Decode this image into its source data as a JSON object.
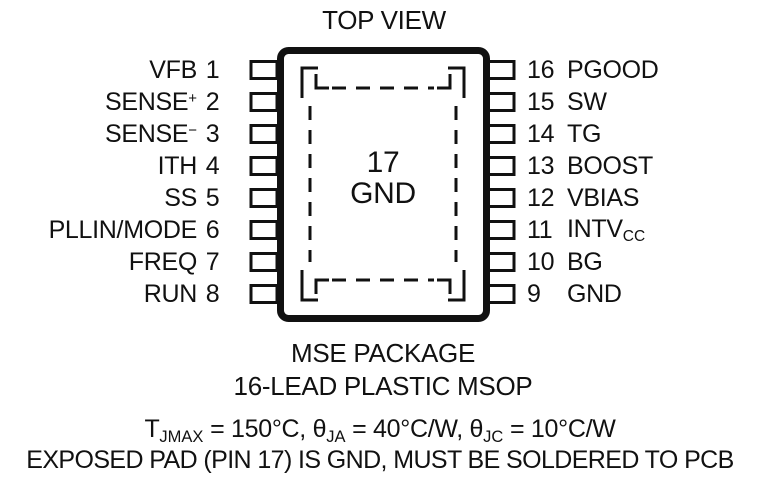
{
  "title": "TOP VIEW",
  "package": {
    "center_pad": {
      "num": "17",
      "label": "GND"
    },
    "pins_left": [
      {
        "num": "1",
        "name": "VFB"
      },
      {
        "num": "2",
        "name": "SENSE",
        "sup": "+"
      },
      {
        "num": "3",
        "name": "SENSE",
        "sup": "−"
      },
      {
        "num": "4",
        "name": "ITH"
      },
      {
        "num": "5",
        "name": "SS"
      },
      {
        "num": "6",
        "name": "PLLIN/MODE"
      },
      {
        "num": "7",
        "name": "FREQ"
      },
      {
        "num": "8",
        "name": "RUN"
      }
    ],
    "pins_right": [
      {
        "num": "16",
        "name": "PGOOD"
      },
      {
        "num": "15",
        "name": "SW"
      },
      {
        "num": "14",
        "name": "TG"
      },
      {
        "num": "13",
        "name": "BOOST"
      },
      {
        "num": "12",
        "name": "VBIAS"
      },
      {
        "num": "11",
        "name": "INTV",
        "sub": "CC"
      },
      {
        "num": "10",
        "name": "BG"
      },
      {
        "num": "9",
        "name": "GND"
      }
    ]
  },
  "captions": {
    "package_name": "MSE PACKAGE",
    "package_desc": "16-LEAD PLASTIC MSOP"
  },
  "notes": {
    "thermal": {
      "t1": "T",
      "s1": "JMAX",
      "t2": " = 150°C, θ",
      "s2": "JA",
      "t3": " = 40°C/W, θ",
      "s3": "JC",
      "t4": " = 10°C/W"
    },
    "exposed_pad": "EXPOSED PAD (PIN 17) IS GND, MUST BE SOLDERED TO PCB"
  },
  "colors": {
    "ink": "#111111",
    "background": "#ffffff"
  }
}
